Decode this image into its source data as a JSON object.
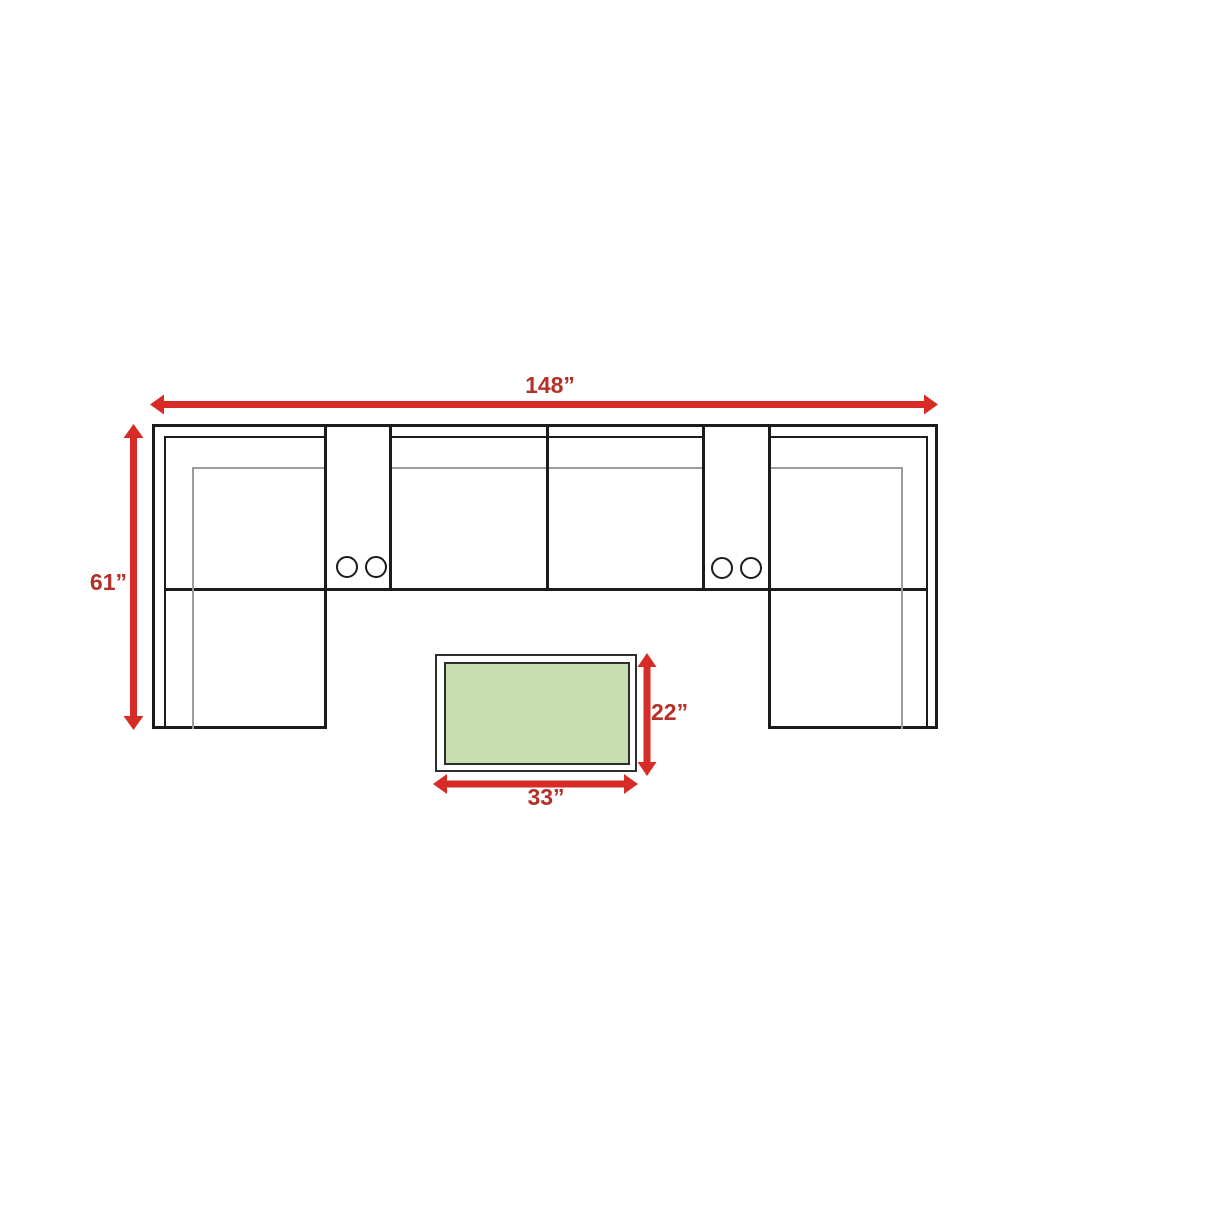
{
  "dimensions": {
    "sofa_width": {
      "label": "148”",
      "inches": 148
    },
    "sofa_depth": {
      "label": "61”",
      "inches": 61
    },
    "ottoman_depth": {
      "label": "22”",
      "inches": 22
    },
    "ottoman_width": {
      "label": "33”",
      "inches": 33
    }
  },
  "colors": {
    "arrow_red": "#d62b26",
    "label_red": "#b43029",
    "line_dark": "#1b1b1b",
    "line_gray": "#9c9c9c",
    "ottoman_green": "#c7dfb2",
    "ottoman_border": "#2e2e2e",
    "background": "#ffffff"
  }
}
